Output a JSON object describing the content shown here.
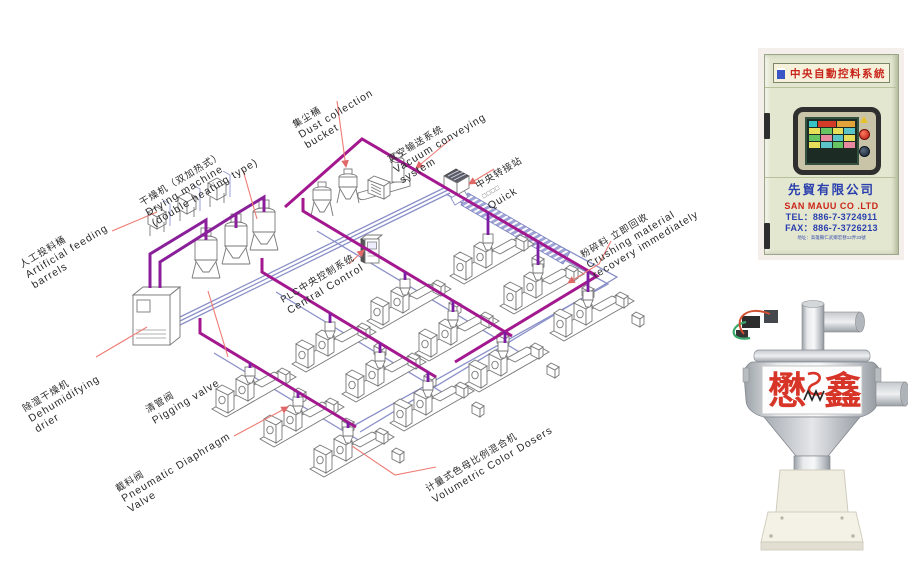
{
  "diagram": {
    "labels": {
      "artificial_feeding": {
        "zh": "人工投料桶",
        "en1": "Artificial feeding",
        "en2": "barrels"
      },
      "drying_machine": {
        "zh": "干燥机（双加热式）",
        "en1": "Drying machine",
        "en2": "(double heating type)"
      },
      "dust_collection": {
        "zh": "集尘桶",
        "en1": "Dust collection",
        "en2": "bucket"
      },
      "vacuum_conveying": {
        "zh": "真空输送系统",
        "en1": "Vacuum conveying",
        "en2": "system"
      },
      "transfer_station": {
        "zh": "中央转接站",
        "en1": "□□□□",
        "en2": "Quick"
      },
      "plc_control": {
        "zh": "PLC中央控制系统",
        "en1": "Central Control"
      },
      "dehumidifying": {
        "zh": "除湿干燥机",
        "en1": "Dehumidifying",
        "en2": "drier"
      },
      "pigging_valve": {
        "zh": "清管阀",
        "en1": "Pigging valve"
      },
      "diaphragm_valve": {
        "zh": "截料阀",
        "en1": "Pneumatic Diaphragm",
        "en2": "Valve"
      },
      "volumetric": {
        "zh": "计量式色母比例混合机",
        "en1": "Volumetric Color Dosers"
      },
      "crushing": {
        "zh": "粉碎料 立即回收",
        "en1": "Crushing material",
        "en2": "recovery immediately"
      }
    },
    "colors": {
      "pipe_main": "#a3188f",
      "pipe_drop": "#7d1da3",
      "pipe_vacuum_blue": "#8a90c8",
      "leader_red": "#ee7b74"
    }
  },
  "cabinet": {
    "title": "中央自動控料系統",
    "company_zh": "先貿有限公司",
    "company_en": "SAN MAUU CO .LTD",
    "tel": "TEL：886-7-3724911",
    "fax": "FAX：886-7-3726213",
    "address": "地址：高雄縣仁武鄉宏巷12弄33號"
  },
  "product": {
    "brand_left": "懋",
    "brand_right": "鑫"
  }
}
